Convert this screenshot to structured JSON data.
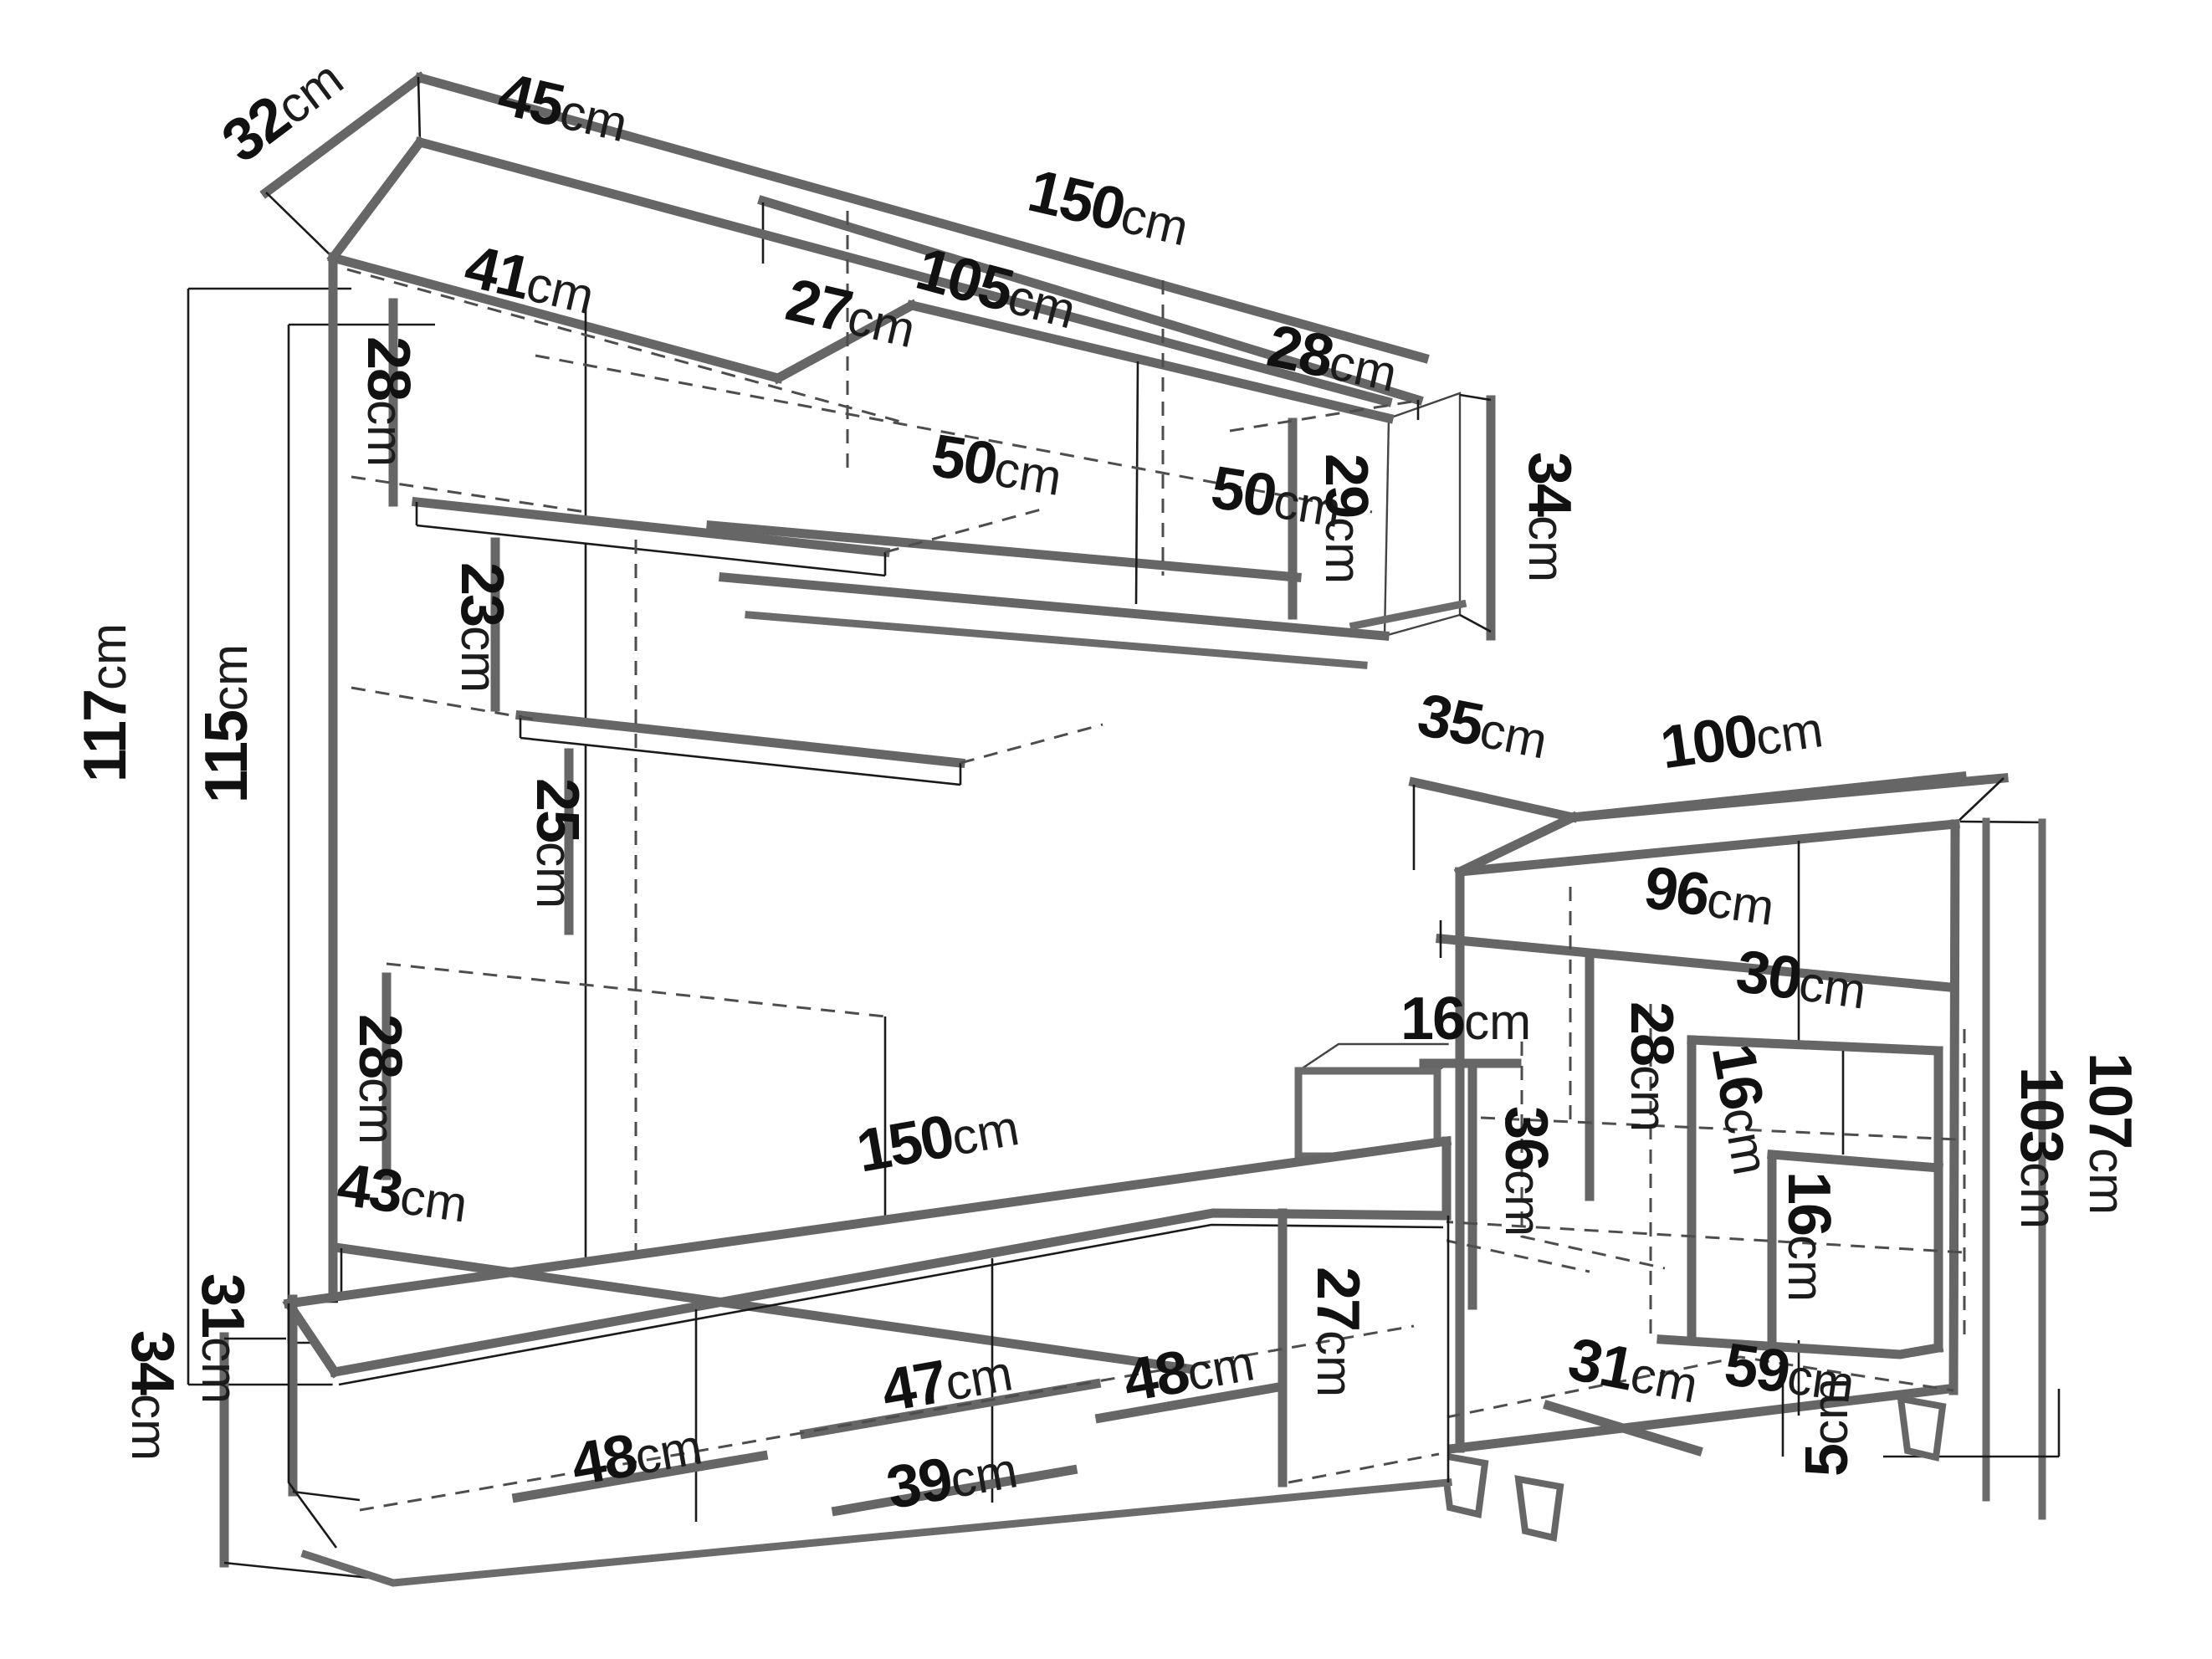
{
  "figure": {
    "type": "furniture-dimension-diagram",
    "unit": "cm",
    "background": "#ffffff",
    "line_color": "#666666",
    "extension_line_color": "#1a1a1a",
    "hidden_line_style": "dashed",
    "text_color": "#111111"
  },
  "wall_unit": {
    "depth_top": {
      "v": "32",
      "u": "cm"
    },
    "column_top_width": {
      "v": "45",
      "u": "cm"
    },
    "total_width": {
      "v": "150",
      "u": "cm"
    },
    "cabinet_width": {
      "v": "105",
      "u": "cm"
    },
    "inner_depth": {
      "v": "41",
      "u": "cm"
    },
    "corner_width": {
      "v": "27",
      "u": "cm"
    },
    "top_section_height": {
      "v": "28",
      "u": "cm"
    },
    "door_left_width": {
      "v": "50",
      "u": "cm"
    },
    "door_right_width": {
      "v": "50",
      "u": "cm"
    },
    "end_depth": {
      "v": "28",
      "u": "cm"
    },
    "end_inner_height": {
      "v": "29",
      "u": "cm"
    },
    "end_height": {
      "v": "34",
      "u": "cm"
    },
    "total_height": {
      "v": "117",
      "u": "cm"
    },
    "inner_height": {
      "v": "115",
      "u": "cm"
    },
    "shelf_gap_upper": {
      "v": "23",
      "u": "cm"
    },
    "shelf_gap_lower": {
      "v": "25",
      "u": "cm"
    },
    "bottom_section_height": {
      "v": "28",
      "u": "cm"
    }
  },
  "display_cabinet": {
    "top_depth": {
      "v": "35",
      "u": "cm"
    },
    "top_width": {
      "v": "100",
      "u": "cm"
    },
    "inner_width": {
      "v": "96",
      "u": "cm"
    },
    "top_inner_height": {
      "v": "28",
      "u": "cm"
    },
    "side_shelf_depth": {
      "v": "16",
      "u": "cm"
    },
    "side_gap_height": {
      "v": "36",
      "u": "cm"
    },
    "niche_top_width": {
      "v": "30",
      "u": "cm"
    },
    "niche_side_depth": {
      "v": "16",
      "u": "cm"
    },
    "niche_inner_height": {
      "v": "16",
      "u": "cm"
    },
    "inner_box_width": {
      "v": "59",
      "u": "cm"
    },
    "total_height": {
      "v": "107",
      "u": "cm"
    },
    "carcass_height": {
      "v": "103",
      "u": "cm"
    },
    "bottom_depth": {
      "v": "31",
      "u": "cm"
    },
    "feet_height": {
      "v": "5",
      "u": "cm"
    }
  },
  "tv_stand": {
    "top_depth": {
      "v": "43",
      "u": "cm"
    },
    "width": {
      "v": "150",
      "u": "cm"
    },
    "right_section_height": {
      "v": "27",
      "u": "cm"
    },
    "door_left_width": {
      "v": "48",
      "u": "cm"
    },
    "door_center_width": {
      "v": "47",
      "u": "cm"
    },
    "door_right_width": {
      "v": "48",
      "u": "cm"
    },
    "bottom_inner_width": {
      "v": "39",
      "u": "cm"
    },
    "inner_height": {
      "v": "31",
      "u": "cm"
    },
    "height": {
      "v": "34",
      "u": "cm"
    }
  }
}
